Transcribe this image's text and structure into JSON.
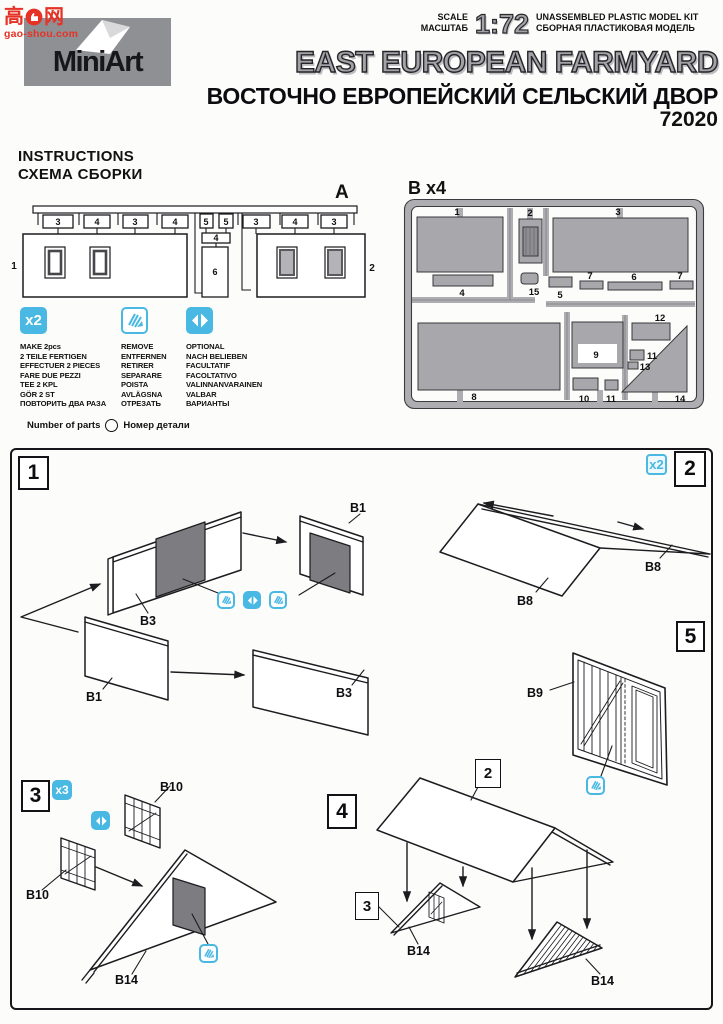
{
  "watermark": {
    "char_left": "高",
    "char_right": "网",
    "site": "gao-shou.com"
  },
  "header": {
    "brand": "MiniArt",
    "scale_label_en": "SCALE",
    "scale_label_ru": "МАСШТАБ",
    "scale_value": "1:72",
    "kit_type_en": "UNASSEMBLED PLASTIC MODEL KIT",
    "kit_type_ru": "СБОРНАЯ ПЛАСТИКОВАЯ МОДЕЛЬ",
    "title_en": "EAST EUROPEAN FARMYARD",
    "title_ru": "ВОСТОЧНО ЕВРОПЕЙСКИЙ СЕЛЬСКИЙ ДВОР",
    "kit_number": "72020"
  },
  "section": {
    "instructions_en": "INSTRUCTIONS",
    "instructions_ru": "СХЕМА СБОРКИ"
  },
  "sprue_a": {
    "label": "A",
    "wall_left": "1",
    "wall_right": "2",
    "parts": [
      "3",
      "4",
      "3",
      "4",
      "5",
      "5",
      "4",
      "6",
      "3",
      "4",
      "3"
    ]
  },
  "sprue_b": {
    "label": "B x4",
    "parts": [
      "1",
      "2",
      "3",
      "4",
      "15",
      "5",
      "7",
      "6",
      "7",
      "8",
      "9",
      "12",
      "11",
      "13",
      "10",
      "11",
      "14"
    ]
  },
  "legend": {
    "multiply": {
      "symbol": "x2",
      "lines": [
        "MAKE 2pcs",
        "2 TEILE FERTIGEN",
        "EFFECTUER 2 PIECES",
        "FARE DUE PEZZI",
        "TEE 2 KPL",
        "GÖR 2 ST",
        "ПОВТОРИТЬ ДВА РАЗА"
      ]
    },
    "remove": {
      "lines": [
        "REMOVE",
        "ENTFERNEN",
        "RETIRER",
        "SEPARARE",
        "POISTA",
        "AVLÄGSNA",
        "ОТРЕЗАТЬ"
      ]
    },
    "optional": {
      "lines": [
        "OPTIONAL",
        "NACH BELIEBEN",
        "FACULTATIF",
        "FACOLTATIVO",
        "VALINNANVARAINEN",
        "VALBAR",
        "ВАРИАНТЫ"
      ]
    },
    "parts_count_en": "Number of parts",
    "parts_count_ru": "Номер детали"
  },
  "steps": {
    "one": {
      "num": "1",
      "label_top_left": "B3",
      "label_bottom_left": "B1",
      "label_top_right": "B1",
      "label_bottom_right": "B3"
    },
    "two": {
      "num": "2",
      "multiplier": "x2",
      "roof_a": "B8",
      "roof_b": "B8"
    },
    "three": {
      "num": "3",
      "multiplier": "x3",
      "shutter_a": "B10",
      "shutter_b": "B10",
      "gable": "B14"
    },
    "four": {
      "num": "4",
      "roof_callout": "2",
      "gable_callout": "3",
      "gable_a": "B14",
      "gable_b": "B14"
    },
    "five": {
      "num": "5",
      "gate": "B9"
    }
  },
  "colors": {
    "accent": "#49b8e3",
    "part_gray": "#a8a8ac",
    "dark_panel": "#7d7d81",
    "logo_gray": "#8f9094",
    "watermark_red": "#e63226"
  }
}
